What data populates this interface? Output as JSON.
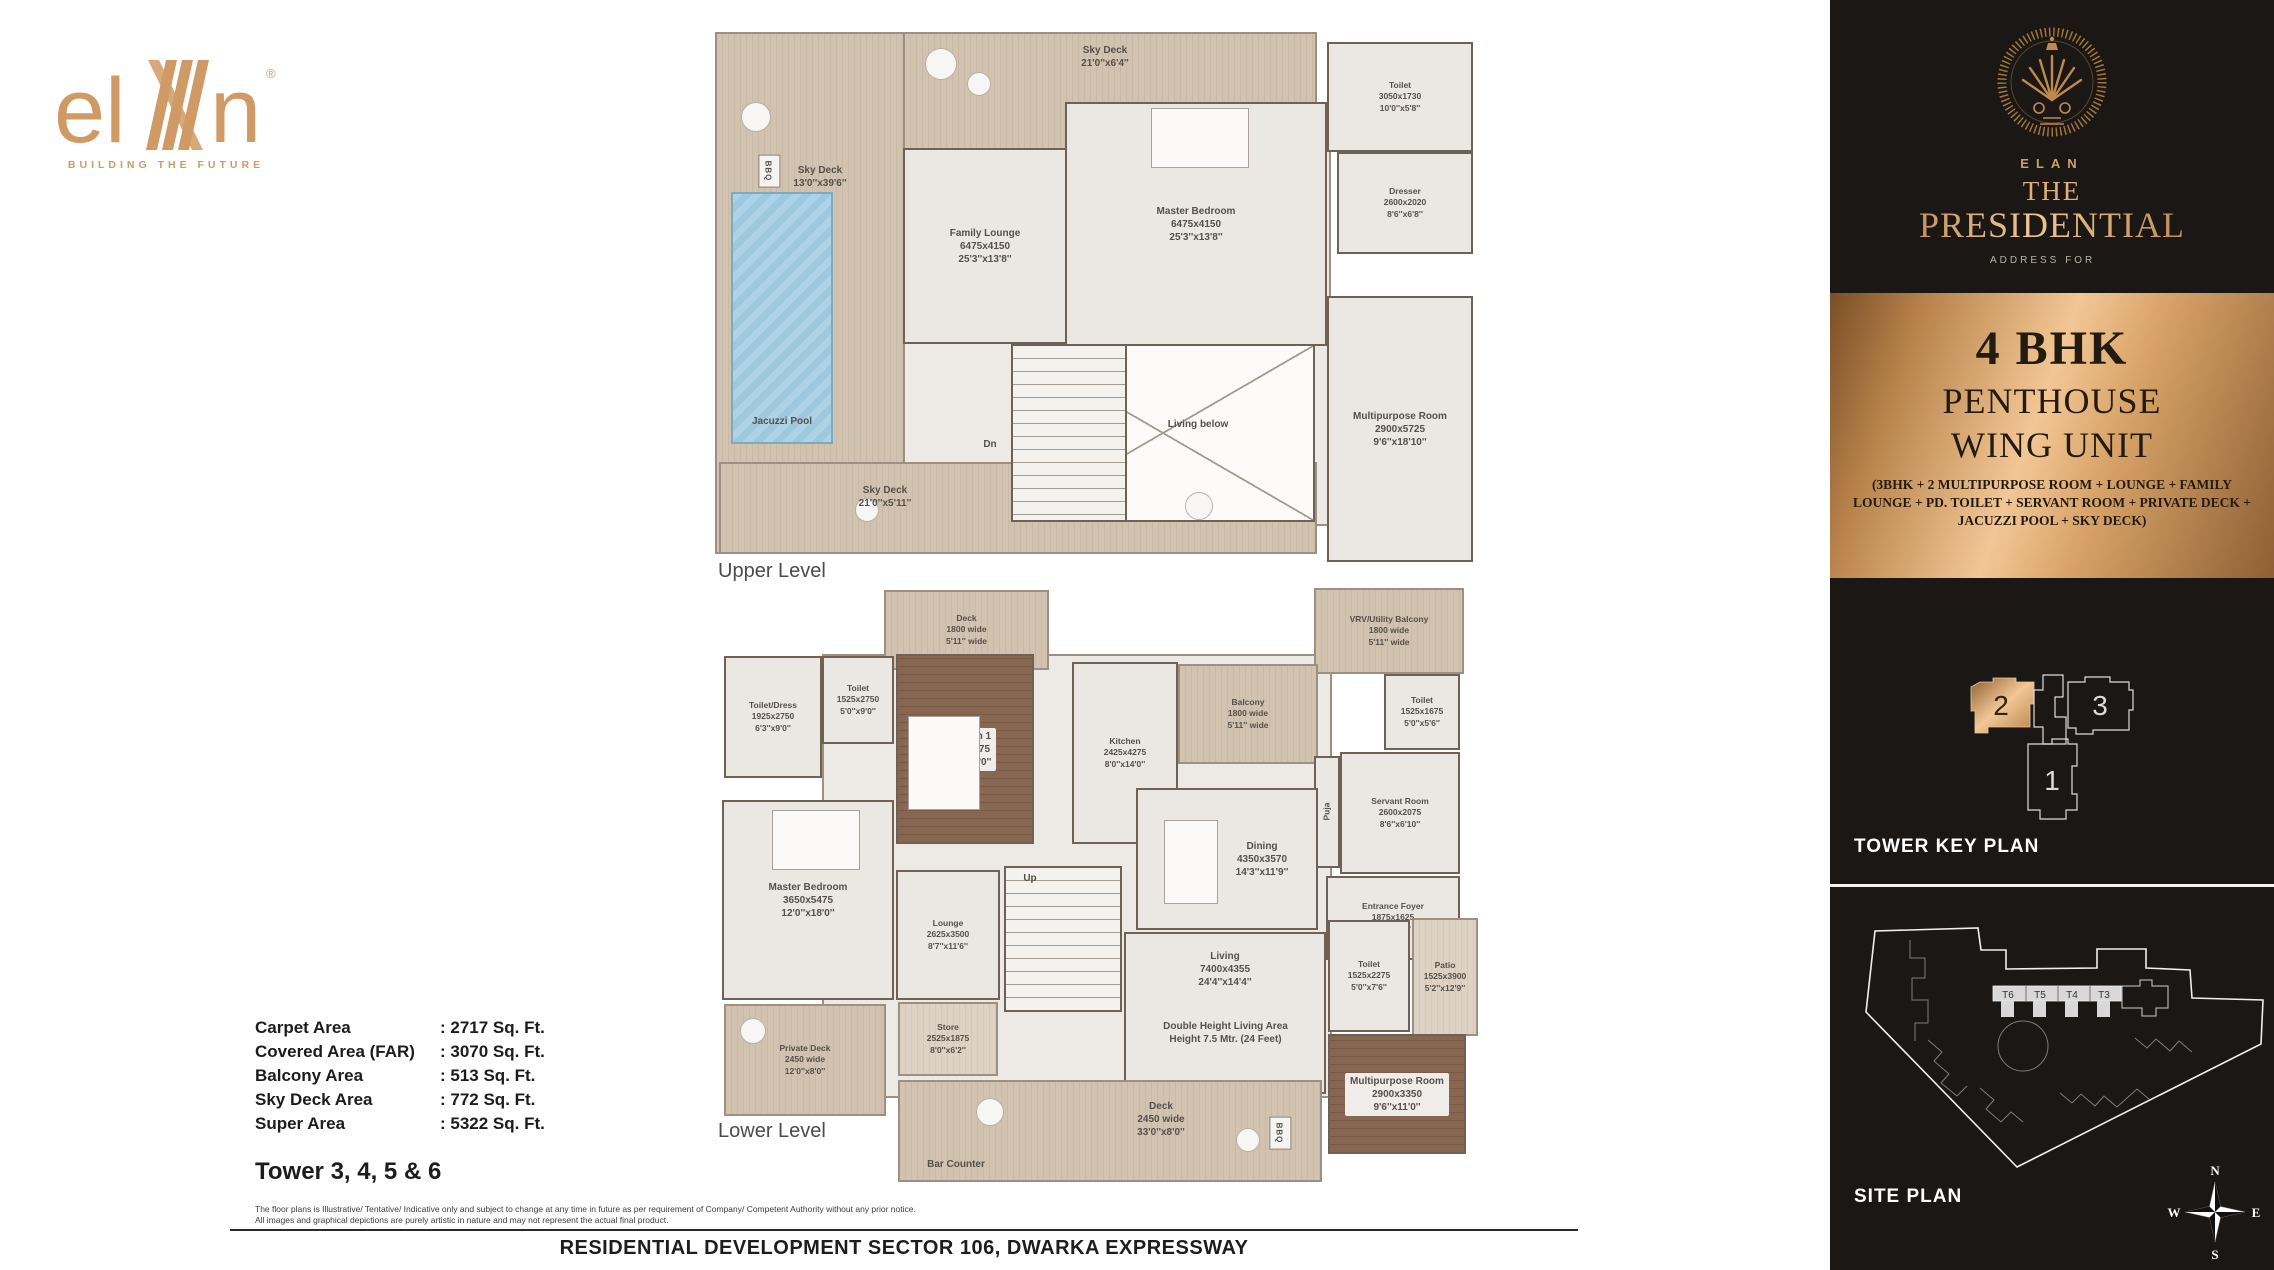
{
  "brand": {
    "logo_left": "el",
    "logo_right": "n",
    "reg": "®",
    "tagline": "BUILDING THE FUTURE"
  },
  "levels": {
    "upper_title": "Upper Level",
    "lower_title": "Lower Level"
  },
  "upper": {
    "rooms": [
      {
        "name": "Sky Deck",
        "ft": "21'0''x6'4''"
      },
      {
        "name": "Sky Deck",
        "ft": "13'0''x39'6''"
      },
      {
        "name": "BBQ"
      },
      {
        "name": "Jacuzzi Pool"
      },
      {
        "name": "Family Lounge",
        "m": "6475x4150",
        "ft": "25'3''x13'8''"
      },
      {
        "name": "Master Bedroom",
        "m": "6475x4150",
        "ft": "25'3''x13'8''"
      },
      {
        "name": "Toilet",
        "m": "3050x1730",
        "ft": "10'0''x5'8''"
      },
      {
        "name": "Dresser",
        "m": "2600x2020",
        "ft": "8'6''x6'8''"
      },
      {
        "name": "Multipurpose Room",
        "m": "2900x5725",
        "ft": "9'6''x18'10''"
      },
      {
        "name": "Living below"
      },
      {
        "name": "Dn"
      },
      {
        "name": "Sky Deck",
        "ft": "21'0''x5'11''"
      }
    ]
  },
  "lower": {
    "rooms": [
      {
        "name": "Deck",
        "m": "1800 wide",
        "ft": "5'11'' wide"
      },
      {
        "name": "VRV/Utility Balcony",
        "m": "1800 wide",
        "ft": "5'11'' wide"
      },
      {
        "name": "Toilet/Dress",
        "m": "1925x2750",
        "ft": "6'3''x9'0''"
      },
      {
        "name": "Toilet",
        "m": "1525x2750",
        "ft": "5'0''x9'0''"
      },
      {
        "name": "Bedroom 1",
        "m": "3350x4275",
        "ft": "11'0''x14'0''"
      },
      {
        "name": "Kitchen",
        "m": "2425x4275",
        "ft": "8'0''x14'0''"
      },
      {
        "name": "Balcony",
        "m": "1800 wide",
        "ft": "5'11'' wide"
      },
      {
        "name": "Toilet",
        "m": "1525x1675",
        "ft": "5'0''x5'6''"
      },
      {
        "name": "Servant Room",
        "m": "2600x2075",
        "ft": "8'6''x6'10''"
      },
      {
        "name": "Puja"
      },
      {
        "name": "Dining",
        "m": "4350x3570",
        "ft": "14'3''x11'9''"
      },
      {
        "name": "Entrance Foyer",
        "m": "1875x1625",
        "ft": "6'2''x5'4''"
      },
      {
        "name": "Patio",
        "m": "1525x3900",
        "ft": "5'2''x12'9''"
      },
      {
        "name": "Toilet",
        "m": "1525x2275",
        "ft": "5'0''x7'6''"
      },
      {
        "name": "Living",
        "m": "7400x4355",
        "ft": "24'4''x14'4''"
      },
      {
        "name": "Double Height Living Area",
        "m": "Height 7.5 Mtr. (24 Feet)"
      },
      {
        "name": "Multipurpose Room",
        "m": "2900x3350",
        "ft": "9'6''x11'0''"
      },
      {
        "name": "Master Bedroom",
        "m": "3650x5475",
        "ft": "12'0''x18'0''"
      },
      {
        "name": "Lounge",
        "m": "2625x3500",
        "ft": "8'7''x11'6''"
      },
      {
        "name": "Store",
        "m": "2525x1875",
        "ft": "8'0''x6'2''"
      },
      {
        "name": "Private Deck",
        "m": "2450 wide",
        "ft": "12'0''x8'0''"
      },
      {
        "name": "Deck",
        "m": "2450 wide",
        "ft": "33'0''x8'0''"
      },
      {
        "name": "Bar Counter"
      },
      {
        "name": "Up"
      },
      {
        "name": "BBQ"
      }
    ]
  },
  "areas": {
    "rows": [
      {
        "label": "Carpet Area",
        "value": ": 2717 Sq. Ft."
      },
      {
        "label": "Covered Area (FAR)",
        "value": ": 3070 Sq. Ft."
      },
      {
        "label": "Balcony Area",
        "value": ": 513 Sq. Ft."
      },
      {
        "label": "Sky Deck Area",
        "value": ": 772 Sq. Ft."
      },
      {
        "label": "Super Area",
        "value": ": 5322 Sq. Ft."
      }
    ],
    "tower": "Tower 3, 4, 5 & 6"
  },
  "disclaimer": {
    "line1": "The floor plans is Illustrative/ Tentative/ Indicative only and subject to change at any time in future as per requirement of Company/ Competent Authority without any prior notice.",
    "line2": "All images and graphical depictions are purely artistic in nature and may not represent the actual final product."
  },
  "footer": "RESIDENTIAL DEVELOPMENT SECTOR 106, DWARKA EXPRESSWAY",
  "sidebar": {
    "brand": {
      "name": "ELAN",
      "the": "THE",
      "title": "PRESIDENTIAL",
      "sub": "ADDRESS FOR"
    },
    "unit": {
      "line1": "4 BHK",
      "line2": "PENTHOUSE",
      "line3": "WING UNIT",
      "details": "(3BHK + 2 MULTIPURPOSE ROOM + LOUNGE + FAMILY LOUNGE + PD. TOILET + SERVANT ROOM + PRIVATE DECK + JACUZZI POOL + SKY DECK)"
    },
    "tower_key": {
      "label": "TOWER KEY PLAN",
      "unit2": "2",
      "unit3": "3",
      "unit1": "1"
    },
    "site": {
      "label": "SITE PLAN",
      "towers": [
        "T6",
        "T5",
        "T4",
        "T3"
      ],
      "compass": {
        "n": "N",
        "e": "E",
        "s": "S",
        "w": "W"
      }
    }
  },
  "colors": {
    "gold": "#c08a4e",
    "wall": "#6f6156",
    "pool": "#a9cfe4",
    "panel_dark": "#1a1714"
  }
}
